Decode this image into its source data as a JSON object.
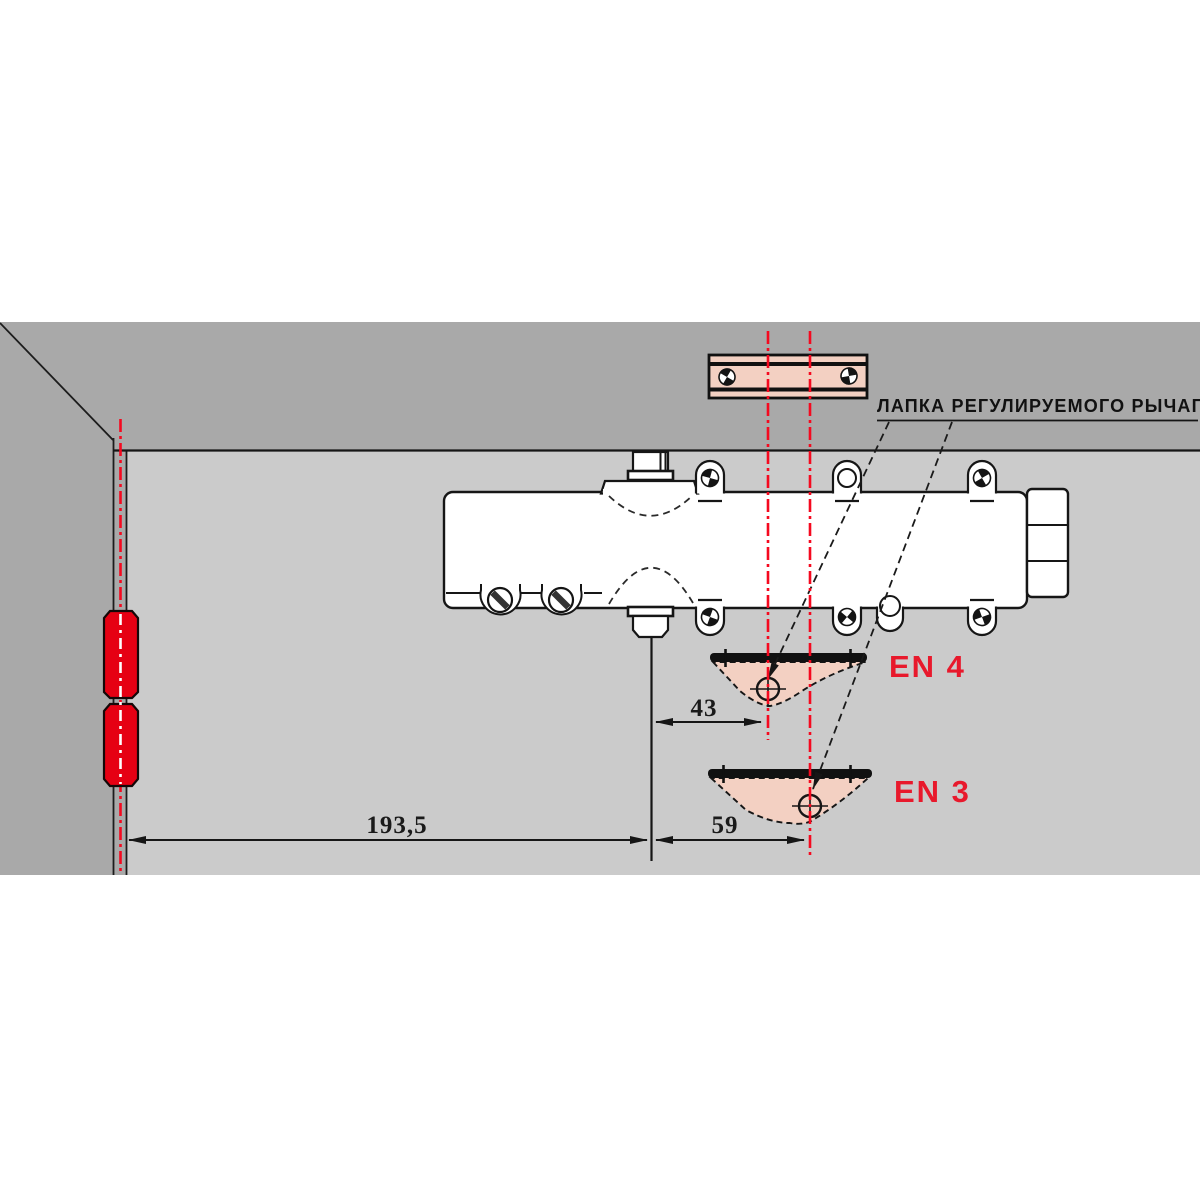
{
  "labels": {
    "arm_foot_callout": "ЛАПКА РЕГУЛИРУЕМОГО РЫЧАГА",
    "en4": "EN 4",
    "en3": "EN 3"
  },
  "dimensions": {
    "hinge_axis_to_spindle": "193,5",
    "spindle_to_en4_hole": "43",
    "spindle_to_en3_hole": "59"
  },
  "colors": {
    "wall": "#a9a9a9",
    "door_leaf": "#cbcbcb",
    "hinge_red": "#e60013",
    "centerline_red": "#f5091f",
    "label_red": "#e8192c",
    "bracket_pink": "#f3d0c2",
    "line_black": "#161616"
  }
}
